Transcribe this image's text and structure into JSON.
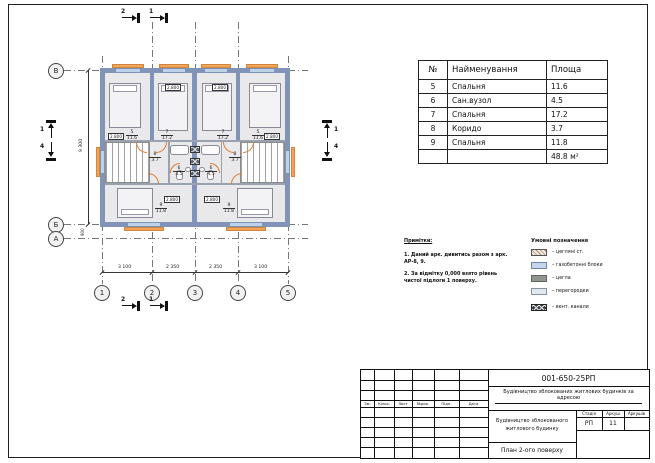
{
  "drawing": {
    "axes": {
      "bottom": [
        "1",
        "2",
        "3",
        "4",
        "5"
      ],
      "left": [
        "В",
        "Б",
        "А"
      ]
    },
    "dimensions": {
      "bottom": [
        "3 100",
        "2 350",
        "2 350",
        "3 100"
      ],
      "left_total": "9 300",
      "left_small": "900"
    },
    "sections": {
      "top_left": "2",
      "top_right": "1",
      "bottom_left": "2",
      "bottom_right": "1",
      "left_up": "1",
      "left_down": "4",
      "right_up": "1",
      "right_down": "4"
    },
    "elevation_mark": "2.800",
    "room_tags": {
      "bedroom_small": {
        "num": "5",
        "area": "11.6"
      },
      "bathroom": {
        "num": "6",
        "area": "4.5"
      },
      "bedroom_large": {
        "num": "7",
        "area": "17.2"
      },
      "corridor": {
        "num": "8",
        "area": "3.7"
      },
      "bedroom_bottom": {
        "num": "9",
        "area": "11.8"
      }
    }
  },
  "room_table": {
    "headers": [
      "№",
      "Найменування",
      "Площа"
    ],
    "rows": [
      [
        "5",
        "Спальня",
        "11.6"
      ],
      [
        "6",
        "Сан.вузол",
        "4.5"
      ],
      [
        "7",
        "Спальня",
        "17.2"
      ],
      [
        "8",
        "Коридо",
        "3.7"
      ],
      [
        "9",
        "Спальня",
        "11.8"
      ]
    ],
    "total": "48.8 м²"
  },
  "notes": {
    "title": "Примітки:",
    "line1": "1. Даний арк. дивитись разом з арк. АР-8, 9.",
    "line2": "2. За відмітку 0,000 взято рівень чистої підлоги 1 поверху."
  },
  "legend": {
    "title": "Умовні позначення",
    "items": [
      {
        "label": "– цегляні ст."
      },
      {
        "label": "– газобетонні блоки"
      },
      {
        "label": "– цегла"
      },
      {
        "label": "– перегородки"
      },
      {
        "label": "– вент. канали"
      }
    ]
  },
  "titleblock": {
    "code": "001-650-25РП",
    "project": "Будівництво зблокованих житлових будинків за адресою",
    "object": "Будівництво зблокованого житлового будинку",
    "sheet_title": "План 2-ого поверху",
    "stage_label": "Стадія",
    "sheet_label": "Аркуш",
    "sheets_label": "Аркушів",
    "stage": "РП",
    "sheet": "11",
    "columns": [
      "Зм.",
      "Кільк.",
      "Лист",
      "№док.",
      "Підп.",
      "Дата"
    ]
  }
}
